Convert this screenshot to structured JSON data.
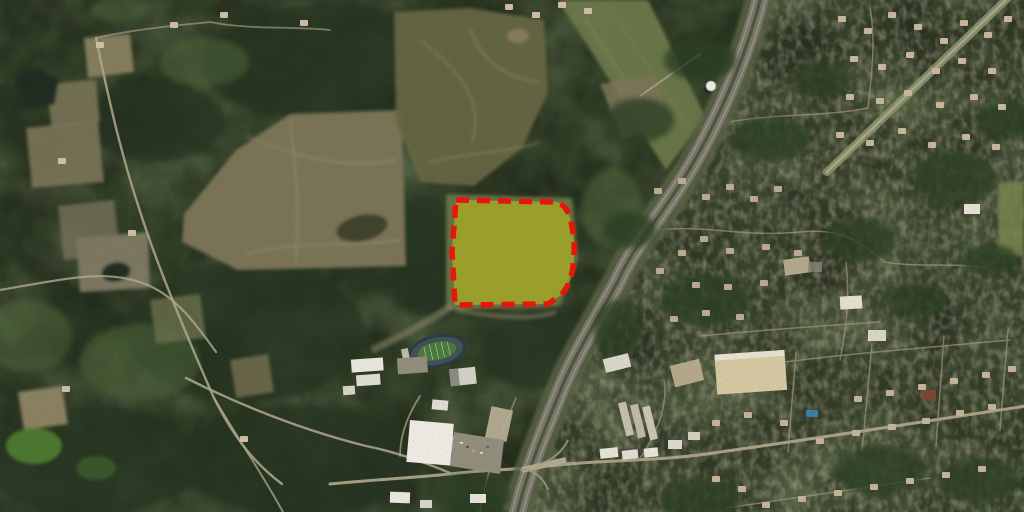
{
  "map": {
    "kind": "aerial-satellite-imagery",
    "description": "Satellite view of a semi-rural area: a land parcel outlined with a thick red dashed boundary and filled with translucent yellow lies west of a divided interstate highway; dark forest and tan farm fields occupy the left, a school campus with an oval football stadium and big-box retail sit at bottom center near a highway interchange, and residential neighborhoods with a town street grid fill the right side.",
    "parcel_overlay": {
      "name": "highlighted-parcel",
      "path": "M456,200 L557,202 Q567,206 570,218 Q575,235 574,257 Q573,282 561,295 L548,304 L455,305 L452,252 Z",
      "fill": "#e9e000",
      "fill_opacity": "0.40",
      "stroke": "#e8150c",
      "stroke_width": "5.5",
      "stroke_dasharray": "13 8"
    },
    "palette": {
      "terrain_base": "#3a492e",
      "forest_dark": "#273420",
      "field_tan": "#7d7659",
      "field_gray": "#7e7a63",
      "cutover": "#696944",
      "meadow": "#6f7a4d",
      "parcel_field": "#687549",
      "road": "#b6ad90",
      "street": "#a39b84",
      "highway_pavement": "#7c796d",
      "highway_median": "#4e593d",
      "highway_clearing": "#5c6546",
      "roof_white": "#f1efe7",
      "roof_tan": "#d9cba4",
      "house": "#cdbb9e",
      "parking": "#95907e",
      "stadium_track": "#44545c",
      "stadium_field": "#4e7c3e",
      "water": "#222e23",
      "pool": "#3f80a4",
      "water_tower": "#f2f0ea"
    },
    "features": [
      "forest",
      "farm-fields",
      "clear-cut-area",
      "ponds",
      "rural-roads",
      "interstate-highway",
      "interchange",
      "overpass",
      "water-tower",
      "school-campus",
      "football-stadium",
      "big-box-store",
      "retail-strip",
      "apartment-buildings",
      "residential-neighborhoods",
      "town-street-grid",
      "highlighted-parcel-boundary"
    ]
  }
}
